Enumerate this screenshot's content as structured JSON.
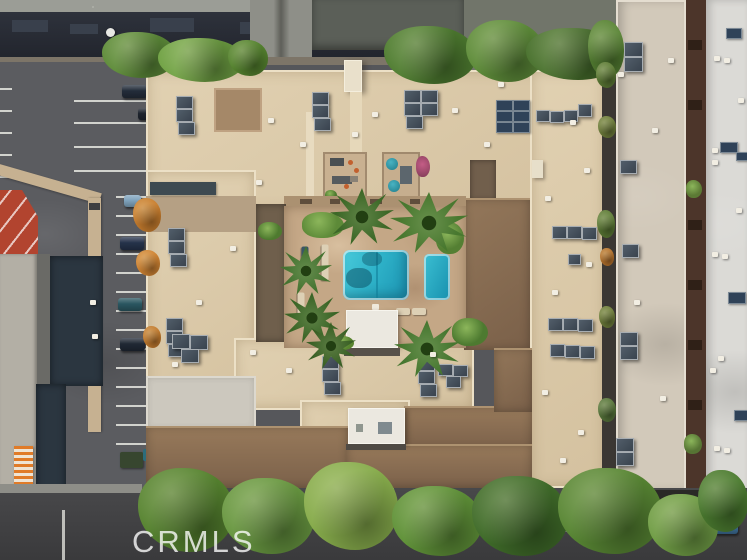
{
  "watermark": {
    "text": "CRMLS"
  },
  "scene": {
    "type": "aerial drone photograph, straight-down view",
    "subject": "Beige multi-wing apartment complex with a central courtyard containing a turquoise swimming pool, smaller spa, stone deck, palm trees and lounge chairs",
    "surroundings": [
      "asphalt parking lot with white striped stalls and parked cars on the left",
      "red-roofed building and dark industrial rooftops at the top and far left",
      "orange striped awning building at lower left",
      "two neighboring flat-roof apartment buildings with HVAC units on the right",
      "narrow alleys between buildings",
      "tree-lined street across the bottom"
    ],
    "features": {
      "pools": 1,
      "spas": 1,
      "rooftop_patios": 2,
      "white_roof_structures": 2,
      "parked_cars_left_lot": 6,
      "street_car": 1
    }
  },
  "palette": {
    "asphalt": "#56575b",
    "street": "#414143",
    "gravel_roof": "#9b9d96",
    "industrial_navy": "#272b34",
    "concrete": "#8e8f88",
    "beige_roof": "#dccaa9",
    "beige_light": "#ece0c4",
    "brown_deck": "#a58868",
    "brown_roof": "#8a6f52",
    "courtyard_stone": "#c4a786",
    "pool_water": "#2fb3c9",
    "spa_water": "#1f9cba",
    "white_structure": "#ebe8e0",
    "hvac_dark": "#46525e",
    "solar_panel": "#2c3a4a",
    "neighbor_gray_roof": "#d2c9ba",
    "alley_brown": "#4c352a",
    "white_roof": "#dbdad6",
    "tree_green": "#55822f",
    "tree_yellow_green": "#86ab4b",
    "tree_orange": "#c97e2e",
    "palm_green": "#3c6827",
    "red_roof": "#b2442f",
    "awning_orange": "#e07b28",
    "parking_line": "#cfd0cc",
    "car_blue": "#3b6b92",
    "watermark_color": "rgba(255,255,255,0.78)"
  }
}
